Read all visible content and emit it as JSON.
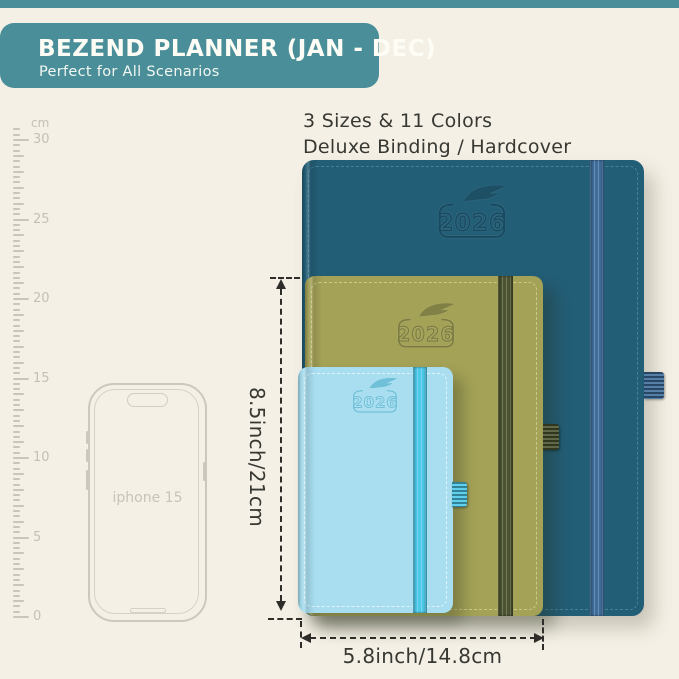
{
  "header": {
    "title": "BEZEND PLANNER (JAN - DEC)",
    "subtitle": "Perfect for All Scenarios",
    "banner_color": "#4a8e99"
  },
  "features": {
    "line1": "3 Sizes & 11 Colors",
    "line2": "Deluxe Binding / Hardcover"
  },
  "ruler": {
    "unit": "cm",
    "max_cm": 30,
    "label_step_cm": 5,
    "labels": [
      "30",
      "25",
      "20",
      "15",
      "10",
      "5",
      "0"
    ]
  },
  "phone": {
    "label": "iphone 15"
  },
  "planners": [
    {
      "id": "large-teal",
      "year": "2026",
      "cover_color": "#235e77",
      "band_color": "#3e6d9b"
    },
    {
      "id": "medium-olive",
      "year": "2026",
      "cover_color": "#a4a257",
      "band_color": "#4b5330"
    },
    {
      "id": "small-blue",
      "year": "2026",
      "cover_color": "#a8def0",
      "band_color": "#4cc9e9"
    }
  ],
  "dimensions": {
    "height_label": "8.5inch/21cm",
    "width_label": "5.8inch/14.8cm"
  },
  "background_color": "#f4f0e5"
}
